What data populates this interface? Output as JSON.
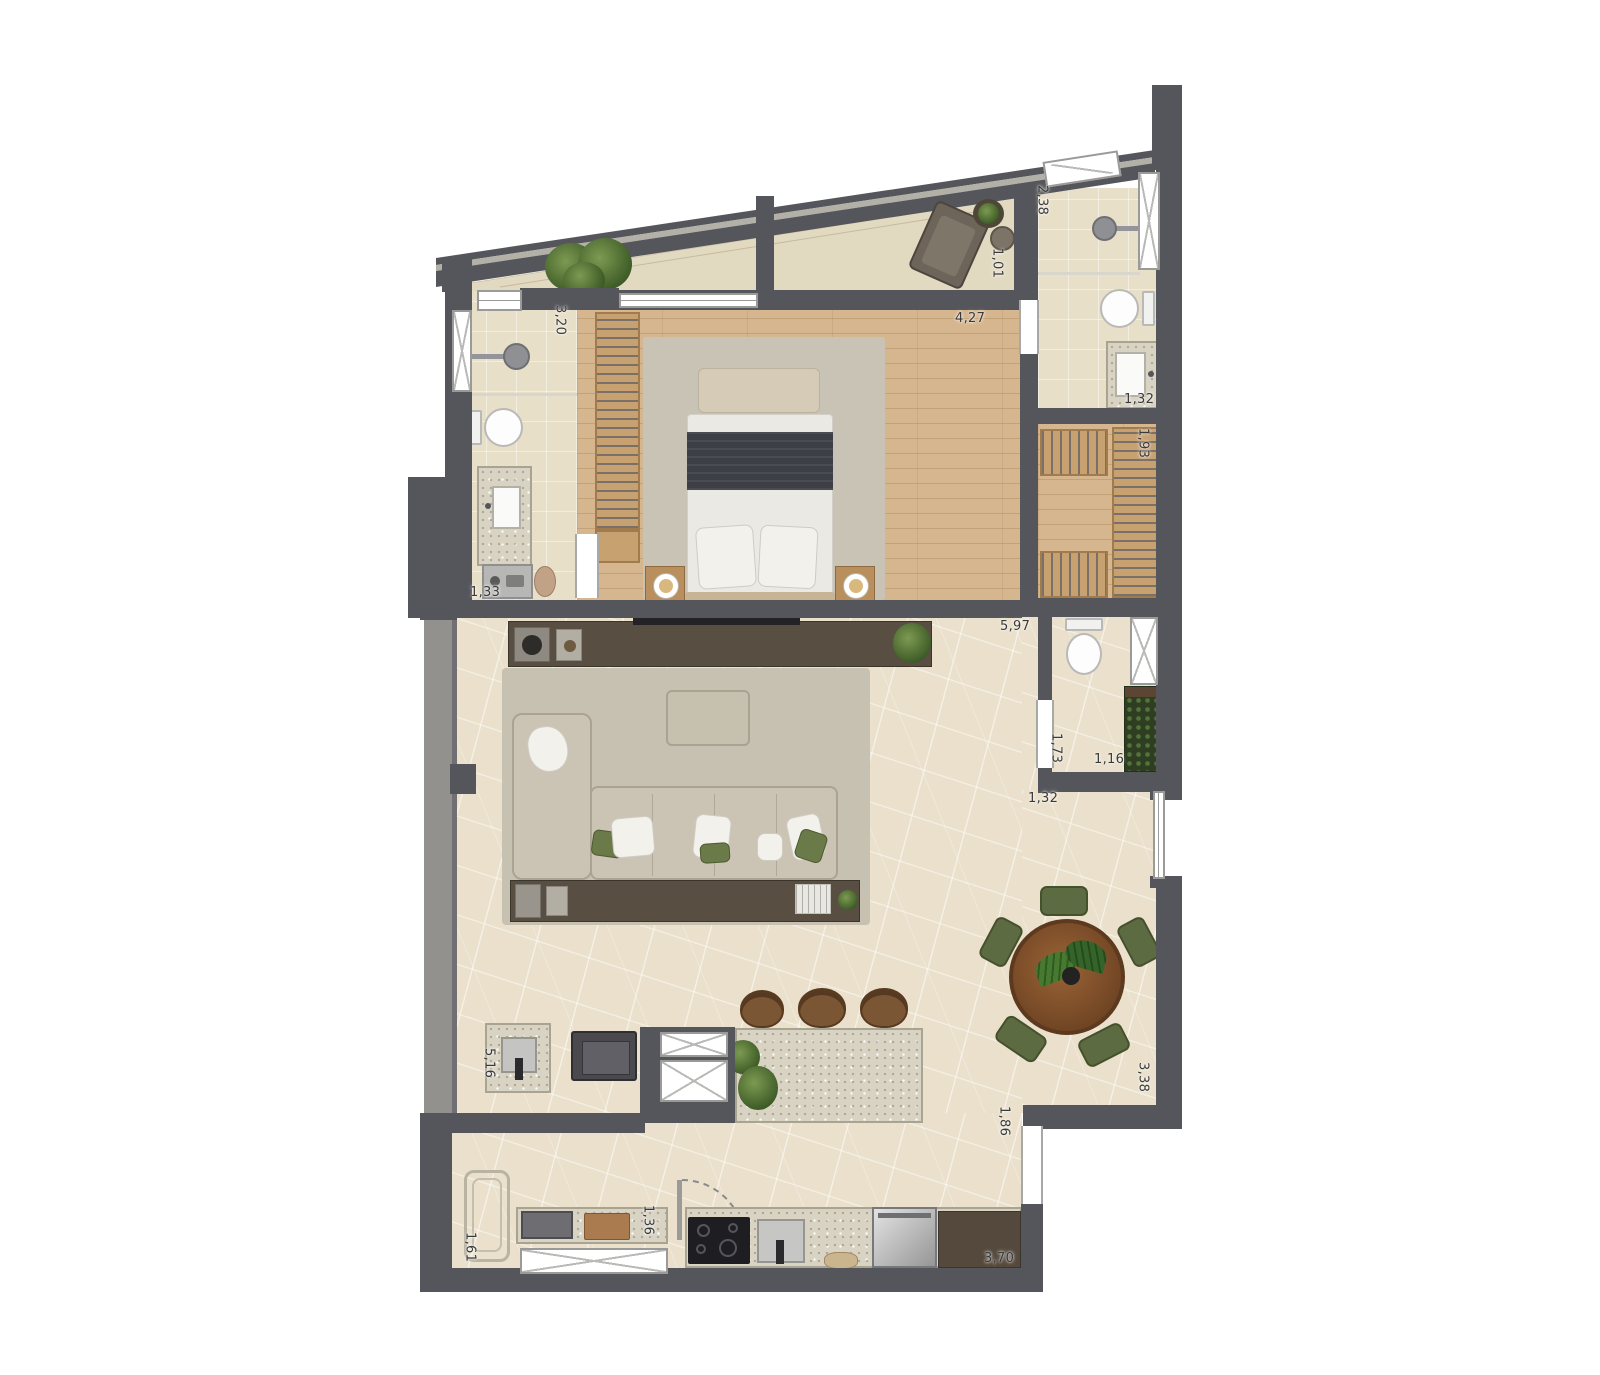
{
  "plan": {
    "type": "apartment-floor-plan",
    "colors": {
      "wall": "#55565b",
      "wood": "#d6b68e",
      "stone": "#eae0cb",
      "tile": "#e8dfc9",
      "counter": "#d9d3c4",
      "green": "#5d6b42",
      "table_wood": "#8a5733",
      "dark_wood": "#584e42"
    },
    "dimensions": {
      "suite_bath_length": "3,20",
      "shower_width": "2,38",
      "terrace_depth": "1,01",
      "bedroom_width": "4,27",
      "bath_vanity": "1,32",
      "closet_width": "1,93",
      "suite_bath_width": "1,33",
      "living_width": "5,97",
      "lavabo_length": "1,73",
      "lavabo_width": "1,16",
      "hall_width": "1,32",
      "kitchen_run": "5,16",
      "service_depth": "1,61",
      "service_counter": "1,36",
      "kitchen_counter": "3,70",
      "balcony_door": "1,86",
      "dining_depth": "3,38"
    }
  }
}
